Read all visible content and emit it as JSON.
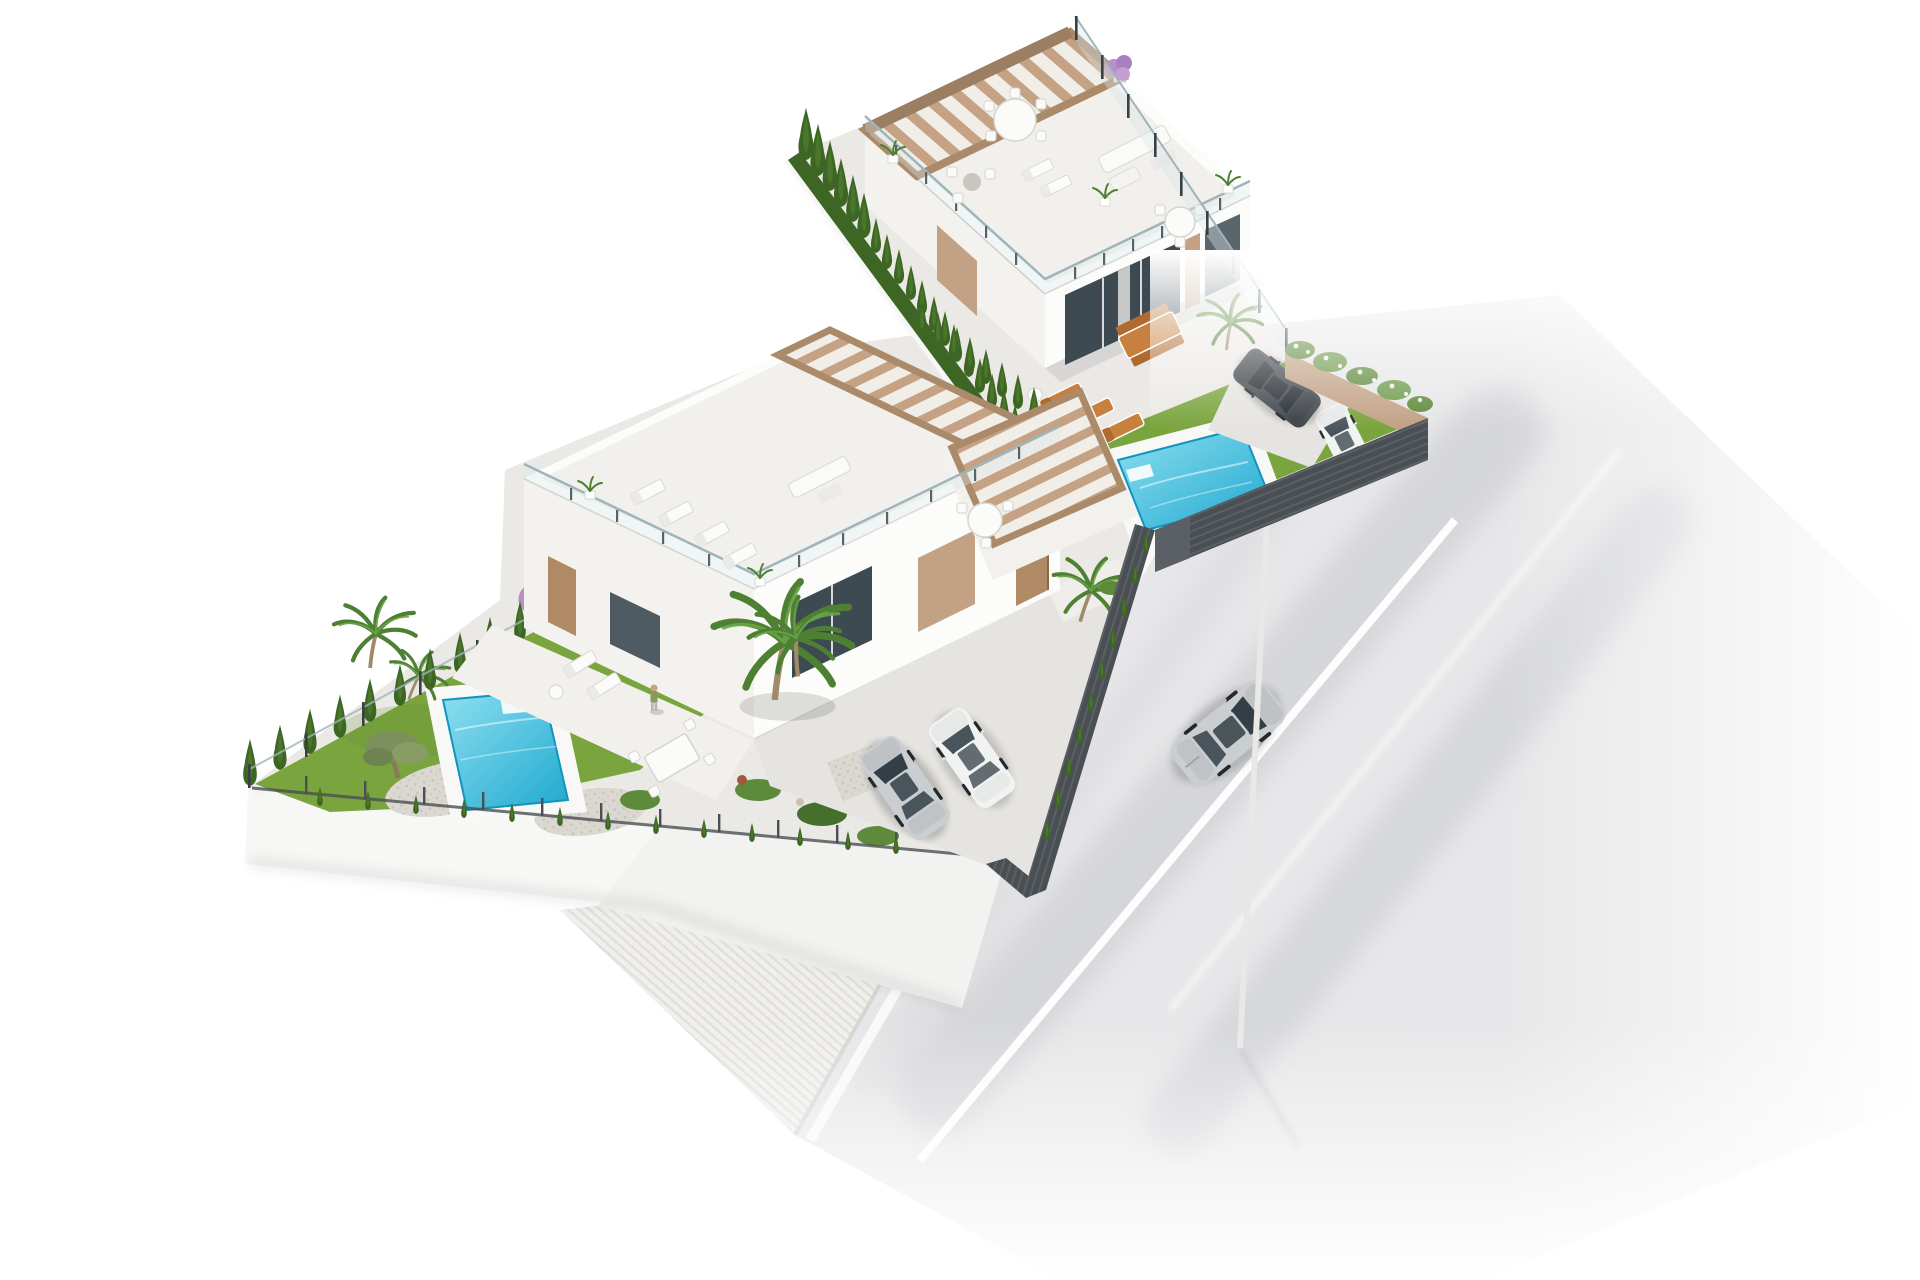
{
  "meta": {
    "title": "Aerial 3D render of two modern villas with pools beside a street",
    "image_kind": "architectural visualization, bird's-eye axonometric view, white background"
  },
  "palette": {
    "background": "#ffffff",
    "road": "#e7e7e9",
    "road_streak": "#c7c8cc",
    "lane_marking": "#ffffff",
    "sidewalk": "#f0efec",
    "sidewalk_rib": "#e0dfdc",
    "curb": "#d6d5d2",
    "ground": "#ebe9e5",
    "patio": "#f1f0ec",
    "driveway": "#e6e4e0",
    "gravel": "#dbd8d1",
    "wall_white": "#f7f7f5",
    "wall_shade": "#e7e6e2",
    "villa_white": "#fcfcfa",
    "villa_face_shade": "#f3f2ee",
    "roof_floor": "#f1f0ec",
    "glass_dark": "#3d4a52",
    "curtain": "#e9e7e2",
    "accent_tan": "#c2a184",
    "door_wood": "#b08a64",
    "pergola_wood": "#c4a283",
    "pergola_beam": "#ab8a6a",
    "pergola_gap": "#f1ede7",
    "railing_glass": "#d9e7ea",
    "railing_post": "#3a3f42",
    "grass": "#7aa43e",
    "grass_dark": "#668e32",
    "hedge_dark": "#3d6624",
    "hedge_light": "#4f7d2e",
    "shrub_green": "#5e8a3c",
    "olive_green": "#7c8f5c",
    "palm_green": "#4e8033",
    "flower_purple": "#b78fc9",
    "flower_white": "#f2f4ee",
    "pool_deck": "#f8f8f6",
    "pool_water_light": "#8edff0",
    "pool_water_deep": "#1fa9cf",
    "pool_edge": "#1295bd",
    "car_silver": "#cbced1",
    "car_silver_shade": "#b4b8bb",
    "car_dark": "#3f454a",
    "car_dark_shade": "#33383c",
    "car_white": "#f1f2f2",
    "car_glass": "#333e46",
    "lamp_white": "#e8e8e6",
    "fence_dark": "#4a4f53",
    "fence_slat": "#5a6065",
    "person_skin": "#caa27e",
    "person_shirt": "#8a9a5b",
    "furniture_white": "#fafaf9",
    "furniture_orange": "#c8803f",
    "furniture_orange_dark": "#b06a30"
  },
  "scene": {
    "street": {
      "name": "asphalt street with white lane markings",
      "vehicles": [
        {
          "name": "silver sedan driving on road",
          "color_key": "car_silver"
        }
      ],
      "furniture": [
        {
          "name": "white street lamp on sidewalk"
        }
      ]
    },
    "upper_villa": {
      "name": "white modern villa with wooden roof pergola",
      "roof_items": [
        "round dining table with chairs",
        "sun loungers",
        "outdoor sofa set",
        "second round table",
        "potted plants",
        "purple bougainvillea pot",
        "glass railing"
      ],
      "ground_items": [
        "orange dining table with benches",
        "three orange sun loungers",
        "sliding glass doors",
        "tan accent panel"
      ],
      "garden": [
        "turquoise swimming pool with deck",
        "lawn",
        "dark parked car",
        "white parked car behind fence",
        "tan garden wall with white-flowering shrubs",
        "palm tree",
        "cypress hedge",
        "glass boundary fence"
      ]
    },
    "lower_villa": {
      "name": "white modern villa with pergola roof terrace",
      "roof_items": [
        "two pairs of white sun loungers",
        "white outdoor sofa",
        "round table under pergola",
        "potted plants",
        "glass railing"
      ],
      "ground_items": [
        "entrance door",
        "tan accent wall",
        "window",
        "patio with person standing",
        "white loungers and dining set",
        "large palm tree"
      ],
      "garden": [
        "turquoise swimming pool with deck",
        "large lawn",
        "olive tree",
        "palm trees",
        "purple bougainvillea",
        "gravel beds and shrubs",
        "cypress hedge rows",
        "two parked cars in driveway",
        "dark slatted street fence",
        "white retaining walls"
      ]
    }
  }
}
